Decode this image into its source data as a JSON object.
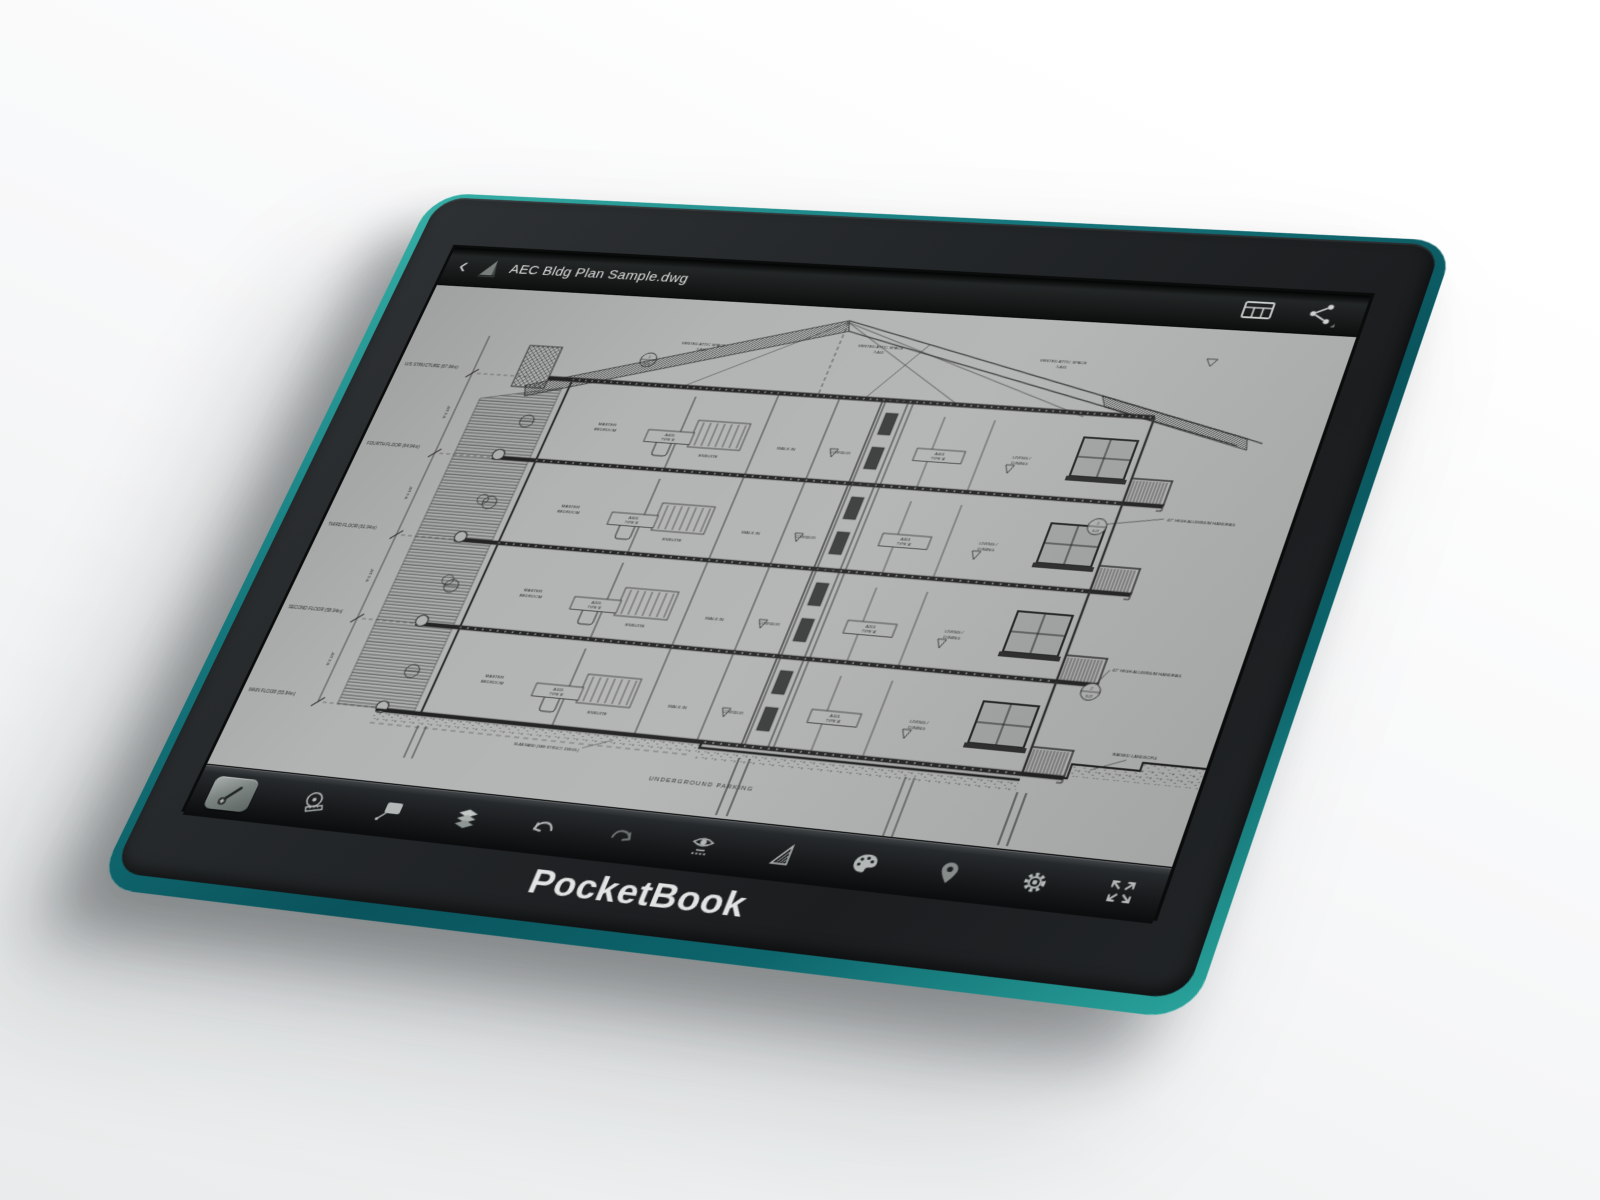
{
  "device": {
    "logo": "PocketBook",
    "rim_color": "#15787d",
    "body_color": "#232628",
    "screen_color": "#b2b4b3"
  },
  "top_bar": {
    "back": "‹",
    "title": "AEC Bldg Plan Sample.dwg",
    "right_icons": [
      "sheets-icon",
      "share-icon"
    ]
  },
  "toolbar": {
    "icons": [
      "annotate",
      "measure",
      "callout",
      "layers",
      "undo",
      "redo",
      "named-views",
      "scale-triangle",
      "palette",
      "location-pin",
      "settings",
      "fullscreen"
    ]
  },
  "drawing": {
    "attic_label": "VENTED ATTIC SPACE",
    "attic_number": "7-A05",
    "levels": [
      "U/S STRUCTURE (67.94m)",
      "FOURTH FLOOR (64.94m)",
      "THIRD FLOOR (61.94m)",
      "SECOND FLOOR (58.94m)",
      "MAIN FLOOR (55.94m)"
    ],
    "storey_dim": "9'-0 1/8\"",
    "rooms": {
      "master": "MASTER",
      "bedroom": "BEDROOM",
      "ensuite": "ENSUITE",
      "walk_in": "WALK IN",
      "corridor": "CORRIDOR",
      "living": "LIVING /",
      "dining": "DINING"
    },
    "type_left": "TYPE 'B'",
    "type_right": "TYPE 'A'",
    "floors": [
      {
        "left_tag": "A405",
        "right_tag": "A401"
      },
      {
        "left_tag": "A305",
        "right_tag": "A301"
      },
      {
        "left_tag": "A205",
        "right_tag": "A201"
      },
      {
        "left_tag": "A105",
        "right_tag": "A101"
      }
    ],
    "callouts": {
      "handrail": "42\" HIGH ALUMINUM HANDRAIL",
      "underground": "UNDERGROUND PARKING",
      "slab_band": "SLAB BAND (SEE STRUCT. DWGS.)",
      "raised": "RAISED LANDSCPG",
      "detail_top": "2",
      "detail_bottom": "S.07",
      "attic_detail_top": "1",
      "attic_detail_bottom": "S.07"
    }
  }
}
